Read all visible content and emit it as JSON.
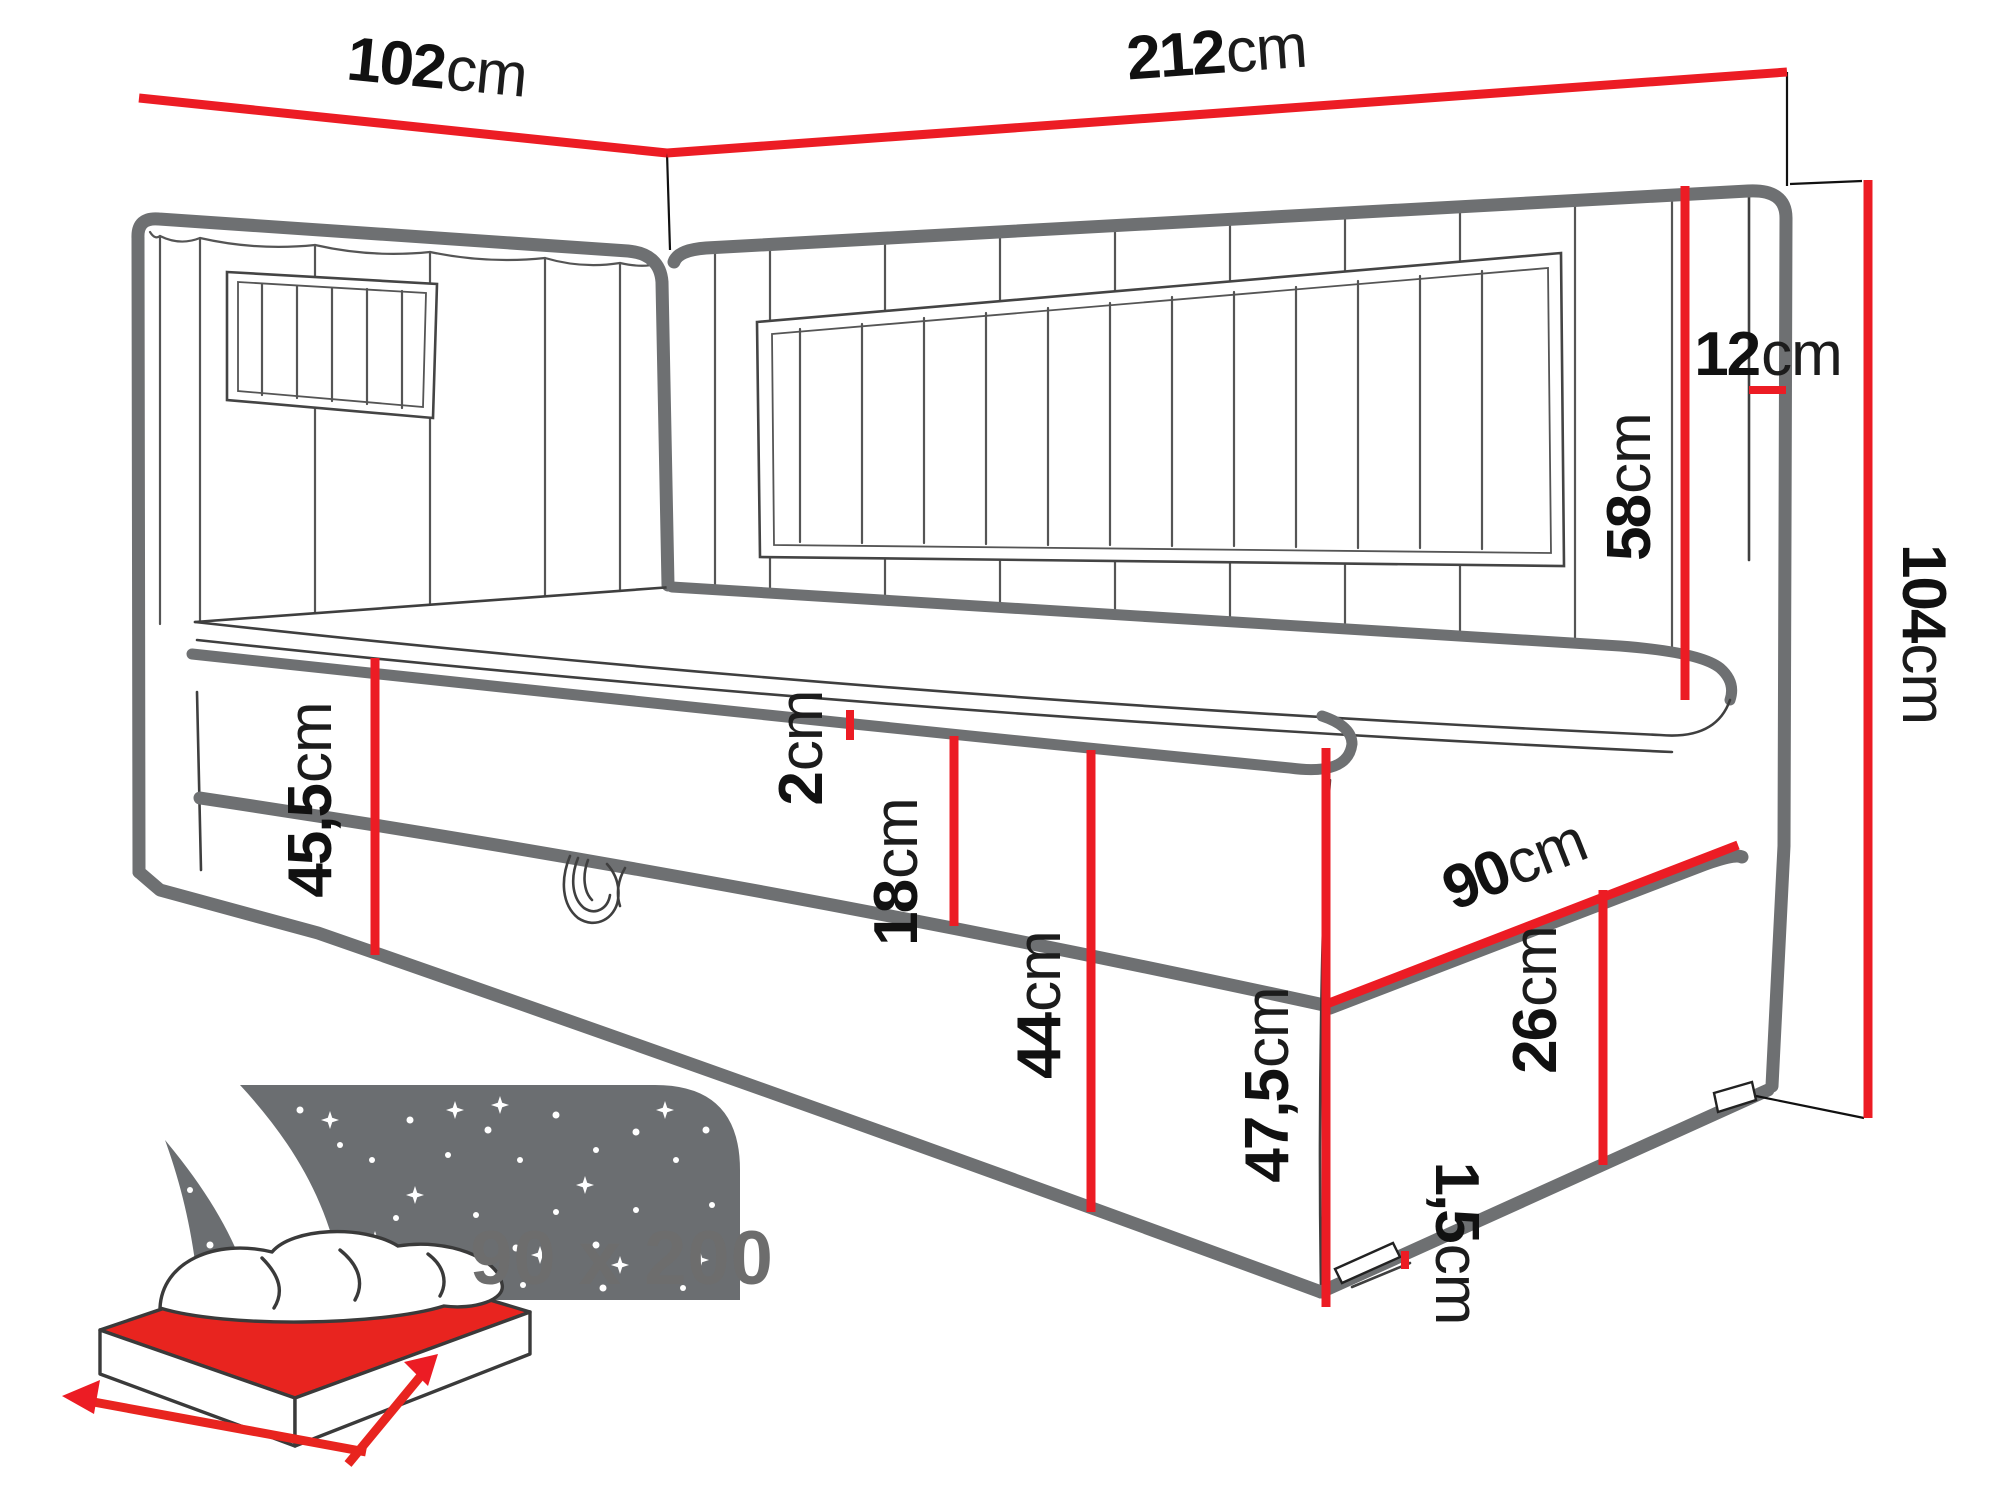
{
  "title": "Corner daybed dimensions diagram",
  "dims": {
    "d102": {
      "value": "102",
      "unit": "cm"
    },
    "d212": {
      "value": "212",
      "unit": "cm"
    },
    "d12": {
      "value": "12",
      "unit": "cm"
    },
    "d58": {
      "value": "58",
      "unit": "cm"
    },
    "d104": {
      "value": "104",
      "unit": "cm"
    },
    "d2": {
      "value": "2",
      "unit": "cm"
    },
    "d18": {
      "value": "18",
      "unit": "cm"
    },
    "d45_5": {
      "value": "45,5",
      "unit": "cm"
    },
    "d44": {
      "value": "44",
      "unit": "cm"
    },
    "d90": {
      "value": "90",
      "unit": "cm"
    },
    "d26": {
      "value": "26",
      "unit": "cm"
    },
    "d47_5": {
      "value": "47,5",
      "unit": "cm"
    },
    "d1_5": {
      "value": "1,5",
      "unit": "cm"
    }
  },
  "icon": {
    "label": "90 x 200"
  },
  "colors": {
    "dimension_red": "#ec1c24",
    "outline_gray": "#6e7072",
    "detail_dark": "#3f3f3f",
    "icon_gray": "#6b6e71",
    "label_black": "#111111",
    "badge_gray": "#6d6d6d"
  }
}
